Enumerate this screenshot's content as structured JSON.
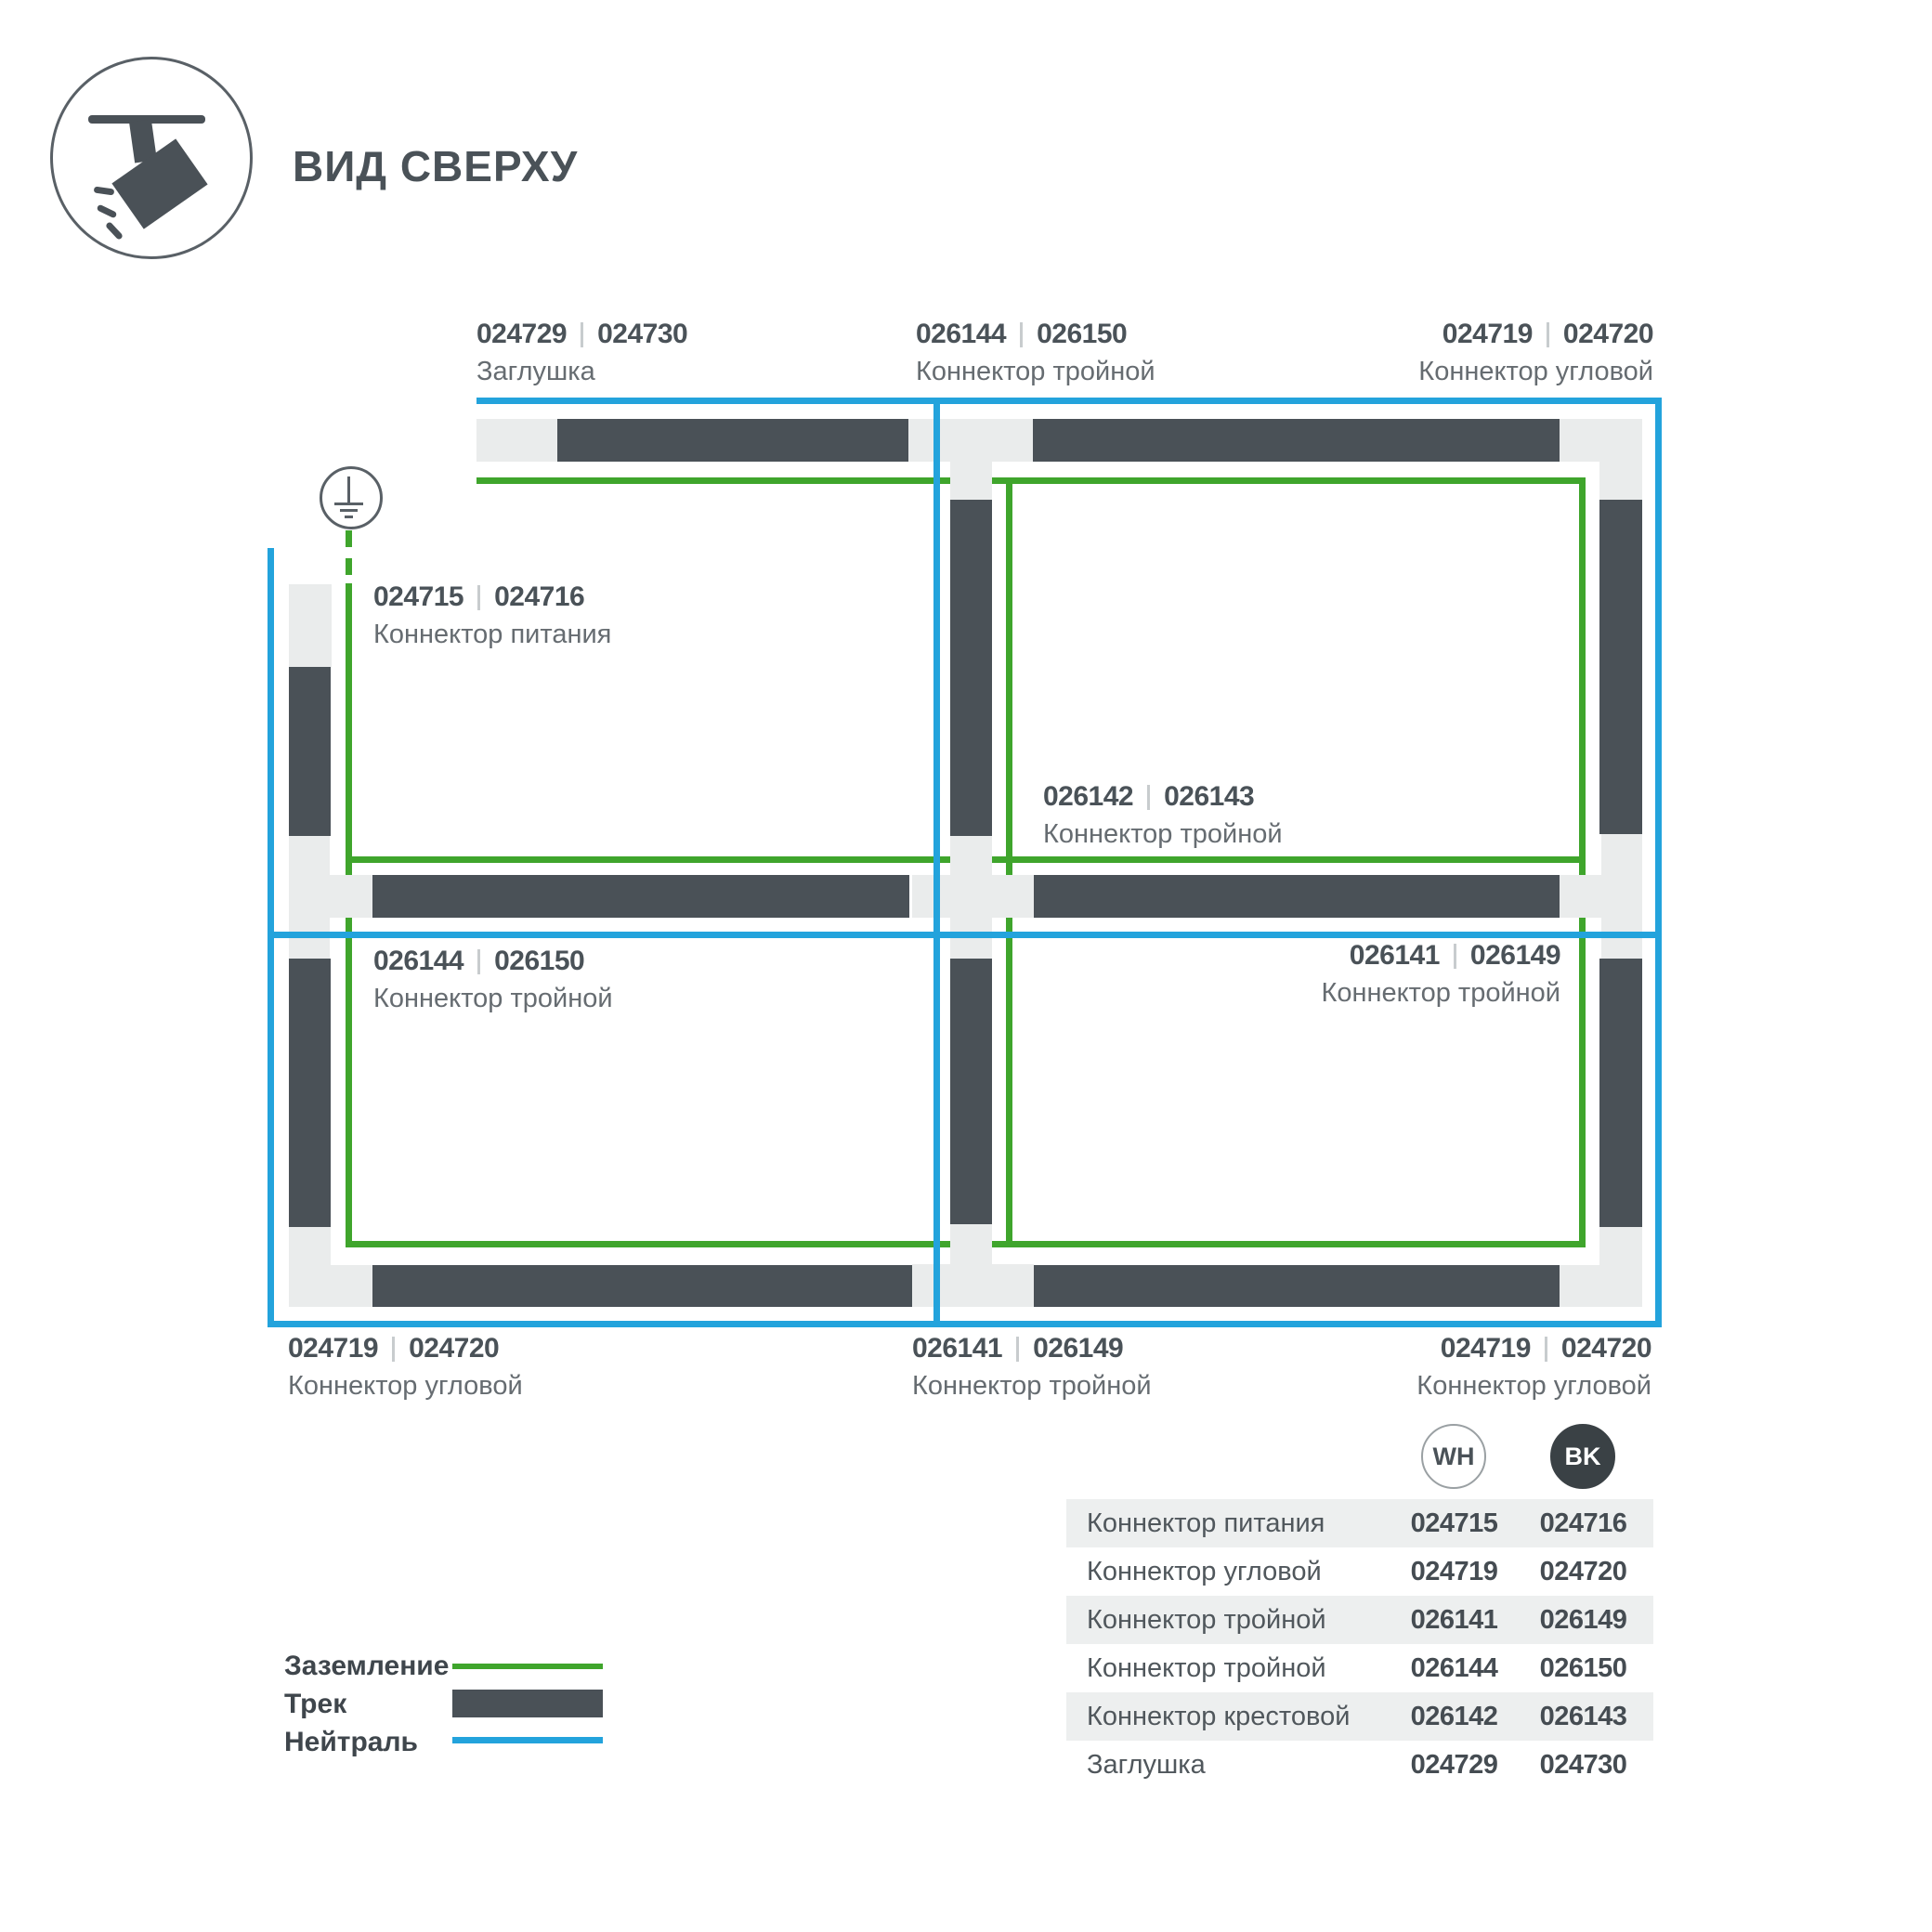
{
  "header": {
    "title": "ВИД СВЕРХУ"
  },
  "colors": {
    "track": "#4A5157",
    "connector": "#EAECEC",
    "ground_green": "#3FA52C",
    "neutral_blue": "#23A3DC",
    "text_dark": "#4A5258",
    "text_gray": "#666C71"
  },
  "diagram": {
    "labels": [
      {
        "codes": [
          "024729",
          "024730"
        ],
        "name": "Заглушка"
      },
      {
        "codes": [
          "026144",
          "026150"
        ],
        "name": "Коннектор тройной"
      },
      {
        "codes": [
          "024719",
          "024720"
        ],
        "name": "Коннектор угловой"
      },
      {
        "codes": [
          "024715",
          "024716"
        ],
        "name": "Коннектор питания"
      },
      {
        "codes": [
          "026142",
          "026143"
        ],
        "name": "Коннектор тройной"
      },
      {
        "codes": [
          "026144",
          "026150"
        ],
        "name": "Коннектор тройной"
      },
      {
        "codes": [
          "026141",
          "026149"
        ],
        "name": "Коннектор тройной"
      },
      {
        "codes": [
          "024719",
          "024720"
        ],
        "name": "Коннектор угловой"
      },
      {
        "codes": [
          "026141",
          "026149"
        ],
        "name": "Коннектор тройной"
      },
      {
        "codes": [
          "024719",
          "024720"
        ],
        "name": "Коннектор угловой"
      }
    ]
  },
  "legend": {
    "items": [
      {
        "label": "Заземление",
        "color": "#3FA52C"
      },
      {
        "label": "Трек",
        "color": "#4A5157"
      },
      {
        "label": "Нейтраль",
        "color": "#23A3DC"
      }
    ]
  },
  "table": {
    "badges": [
      {
        "label": "WH"
      },
      {
        "label": "BK"
      }
    ],
    "rows": [
      {
        "name": "Коннектор питания",
        "wh": "024715",
        "bk": "024716"
      },
      {
        "name": "Коннектор угловой",
        "wh": "024719",
        "bk": "024720"
      },
      {
        "name": "Коннектор тройной",
        "wh": "026141",
        "bk": "026149"
      },
      {
        "name": "Коннектор тройной",
        "wh": "026144",
        "bk": "026150"
      },
      {
        "name": "Коннектор крестовой",
        "wh": "026142",
        "bk": "026143"
      },
      {
        "name": "Заглушка",
        "wh": "024729",
        "bk": "024730"
      }
    ]
  }
}
